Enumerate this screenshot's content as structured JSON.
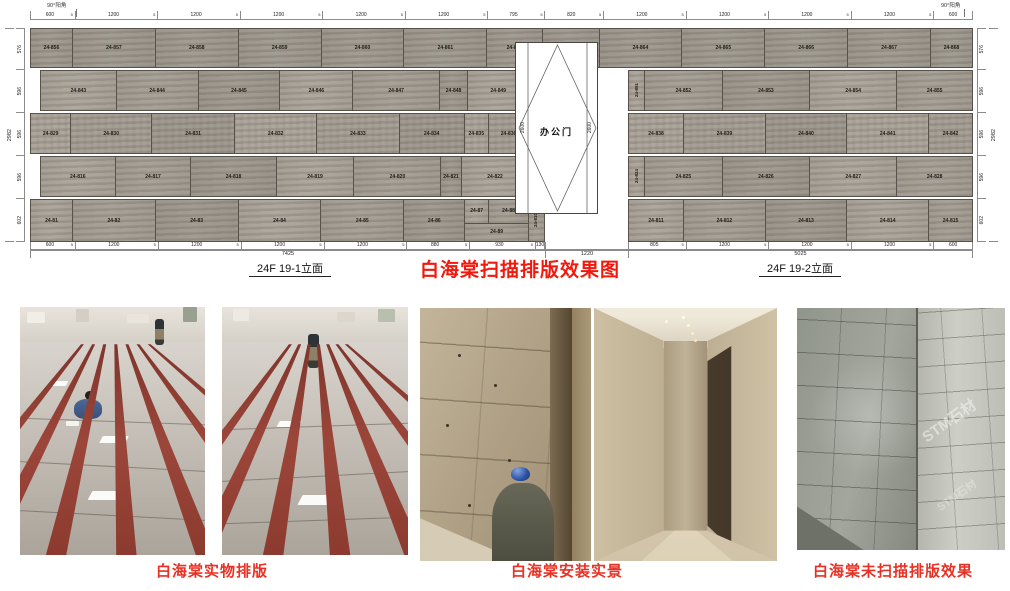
{
  "title": "白海棠扫描排版效果图",
  "elevation": {
    "corner_left": "90°阳角",
    "corner_right": "90°阳角",
    "label_left_wall": "24F 19-1立面",
    "label_right_wall": "24F 19-2立面",
    "joint": "5",
    "door": {
      "name": "办公门",
      "width": "1220",
      "height_left": "2600",
      "height_right": "2600"
    },
    "dims_top": [
      600,
      1200,
      1200,
      1200,
      1200,
      1200,
      795,
      820,
      1200,
      1200,
      1200,
      1200,
      600
    ],
    "dims_bottom_left": [
      600,
      1200,
      1200,
      1200,
      1200,
      880,
      930,
      130
    ],
    "dims_bottom_right": [
      805,
      1200,
      1200,
      1200,
      600
    ],
    "total_left": "7425",
    "total_door": "1220",
    "total_right": "5025",
    "dims_side_left": [
      576,
      596,
      596,
      596,
      602
    ],
    "dims_side_right": [
      576,
      596,
      596,
      596,
      602
    ],
    "total_height": "2982",
    "rows": [
      {
        "h": 40,
        "full": [
          {
            "l": "24-856",
            "w": 600
          },
          {
            "l": "24-857",
            "w": 1200
          },
          {
            "l": "24-858",
            "w": 1200
          },
          {
            "l": "24-859",
            "w": 1200
          },
          {
            "l": "24-860",
            "w": 1200
          },
          {
            "l": "24-861",
            "w": 1200
          },
          {
            "l": "24-862",
            "w": 795
          },
          {
            "l": "24-863",
            "w": 820
          },
          {
            "l": "24-864",
            "w": 1200
          },
          {
            "l": "24-865",
            "w": 1200
          },
          {
            "l": "24-866",
            "w": 1200
          },
          {
            "l": "24-867",
            "w": 1200
          },
          {
            "l": "24-868",
            "w": 600
          }
        ]
      },
      {
        "h": 41,
        "inset": true,
        "left": [
          {
            "l": "24-843",
            "w": 1120
          },
          {
            "l": "24-844",
            "w": 1210
          },
          {
            "l": "24-845",
            "w": 1210
          },
          {
            "l": "24-846",
            "w": 1080
          },
          {
            "l": "24-847",
            "w": 1280
          },
          {
            "l": "24-848",
            "w": 410
          },
          {
            "l": "24-849",
            "w": 900
          },
          {
            "l": "24-850",
            "w": 220,
            "v": true
          }
        ],
        "right": [
          {
            "l": "24-851",
            "w": 220,
            "v": true
          },
          {
            "l": "24-852",
            "w": 1120
          },
          {
            "l": "24-853",
            "w": 1260
          },
          {
            "l": "24-854",
            "w": 1260
          },
          {
            "l": "24-855",
            "w": 1090
          }
        ]
      },
      {
        "h": 41,
        "left": [
          {
            "l": "24-829",
            "w": 580
          },
          {
            "l": "24-830",
            "w": 1180
          },
          {
            "l": "24-831",
            "w": 1210
          },
          {
            "l": "24-832",
            "w": 1200
          },
          {
            "l": "24-833",
            "w": 1200
          },
          {
            "l": "24-834",
            "w": 950
          },
          {
            "l": "24-835",
            "w": 340
          },
          {
            "l": "24-836",
            "w": 580
          },
          {
            "l": "24-837",
            "w": 220,
            "v": true
          }
        ],
        "right": [
          {
            "l": "24-838",
            "w": 805
          },
          {
            "l": "24-839",
            "w": 1200
          },
          {
            "l": "24-840",
            "w": 1200
          },
          {
            "l": "24-841",
            "w": 1200
          },
          {
            "l": "24-842",
            "w": 640
          }
        ]
      },
      {
        "h": 41,
        "inset": true,
        "left": [
          {
            "l": "24-816",
            "w": 1120
          },
          {
            "l": "24-817",
            "w": 1140
          },
          {
            "l": "24-818",
            "w": 1280
          },
          {
            "l": "24-819",
            "w": 1170
          },
          {
            "l": "24-820",
            "w": 1310
          },
          {
            "l": "24-821",
            "w": 290
          },
          {
            "l": "24-822",
            "w": 1020
          },
          {
            "l": "24-823",
            "w": 220,
            "v": true
          }
        ],
        "right": [
          {
            "l": "24-824",
            "w": 220,
            "v": true
          },
          {
            "l": "24-825",
            "w": 1120
          },
          {
            "l": "24-826",
            "w": 1260
          },
          {
            "l": "24-827",
            "w": 1260
          },
          {
            "l": "24-828",
            "w": 1090
          }
        ]
      },
      {
        "h": 43,
        "left": [
          {
            "l": "24-81",
            "w": 600
          },
          {
            "l": "24-82",
            "w": 1200
          },
          {
            "l": "24-83",
            "w": 1200
          },
          {
            "l": "24-84",
            "w": 1200
          },
          {
            "l": "24-85",
            "w": 1200
          },
          {
            "l": "24-86",
            "w": 880
          },
          {
            "w": 920,
            "group": {
              "top": [
                {
                  "l": "24-87",
                  "w": 340
                },
                {
                  "l": "24-88",
                  "w": 580
                }
              ],
              "bottom": {
                "l": "24-89"
              }
            }
          },
          {
            "l": "24-810",
            "w": 220,
            "v": true
          }
        ],
        "right": [
          {
            "l": "24-811",
            "w": 805
          },
          {
            "l": "24-812",
            "w": 1200
          },
          {
            "l": "24-813",
            "w": 1200
          },
          {
            "l": "24-814",
            "w": 1200
          },
          {
            "l": "24-815",
            "w": 640
          }
        ]
      }
    ]
  },
  "photos": {
    "caption_layout": "白海棠实物排版",
    "caption_install": "白海棠安装实景",
    "caption_unscanned": "白海棠未扫描排版效果",
    "watermark": "STM石材"
  },
  "colors": {
    "title_red": "#f2180c",
    "caption_red": "#ea3023",
    "stone": "#a09a90",
    "stripe_red": "#8c3a2f"
  }
}
